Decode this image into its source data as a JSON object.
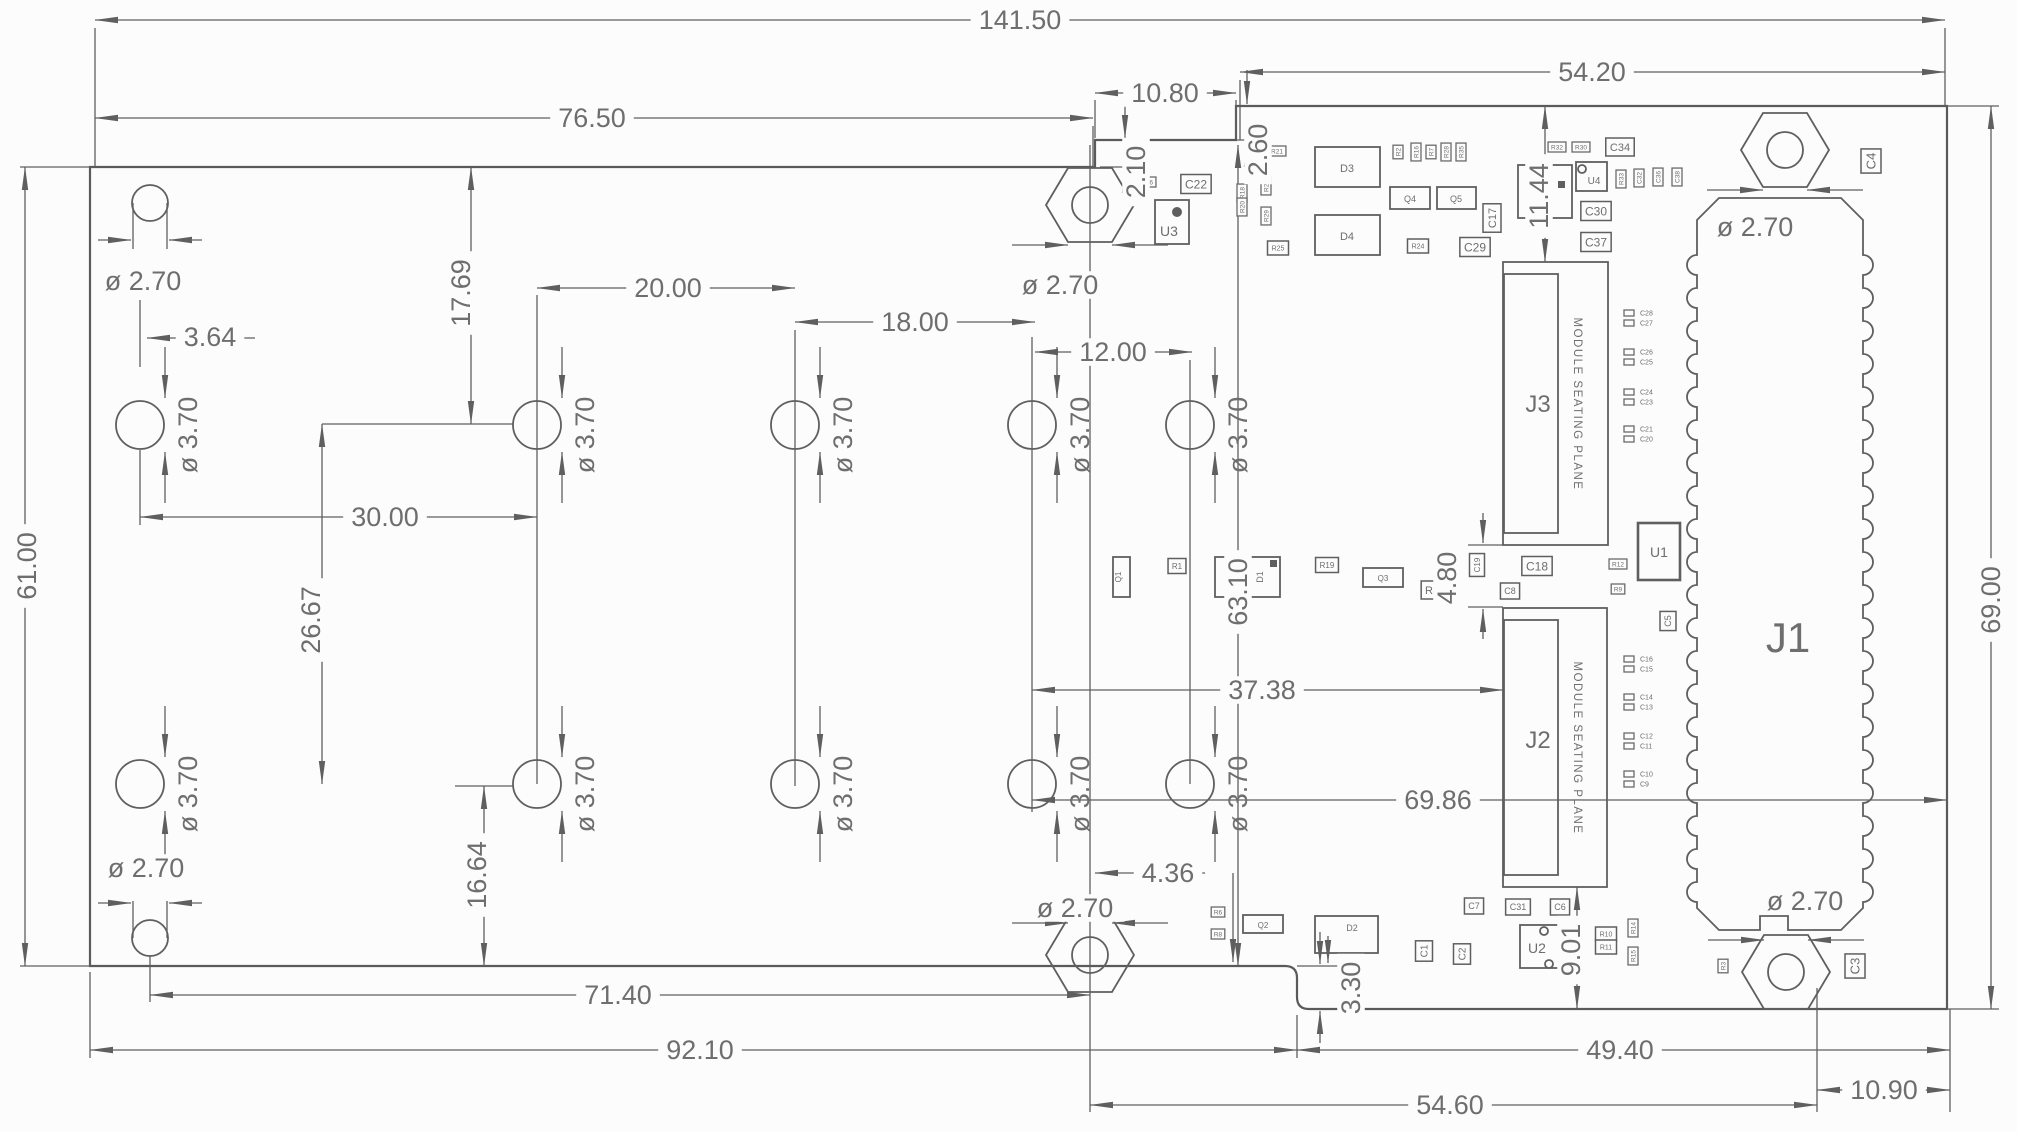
{
  "drawing": {
    "colors": {
      "line": "#5f5f5f",
      "text": "#6e6e6e",
      "background": "#fcfcfc"
    },
    "hole_label": "ø 3.70",
    "dims": [
      {
        "id": "total-width",
        "text": "141.50",
        "x": 1020,
        "y": 20,
        "rot": 0
      },
      {
        "id": "left-top-width",
        "text": "76.50",
        "x": 592,
        "y": 118,
        "rot": 0
      },
      {
        "id": "right-top-width",
        "text": "54.20",
        "x": 1592,
        "y": 72,
        "rot": 0
      },
      {
        "id": "notch-width",
        "text": "10.80",
        "x": 1165,
        "y": 93,
        "rot": 0
      },
      {
        "id": "notch-depth",
        "text": "2.10",
        "x": 1136,
        "y": 172,
        "rot": -90
      },
      {
        "id": "top-step",
        "text": "2.60",
        "x": 1258,
        "y": 150,
        "rot": -90
      },
      {
        "id": "left-height",
        "text": "61.00",
        "x": 27,
        "y": 566,
        "rot": -90
      },
      {
        "id": "right-height",
        "text": "69.00",
        "x": 1991,
        "y": 600,
        "rot": -90
      },
      {
        "id": "hole-a-offset",
        "text": "3.64",
        "x": 210,
        "y": 337,
        "rot": 0
      },
      {
        "id": "top-row-offset",
        "text": "17.69",
        "x": 461,
        "y": 293,
        "rot": -90
      },
      {
        "id": "pitch-30",
        "text": "30.00",
        "x": 385,
        "y": 517,
        "rot": 0
      },
      {
        "id": "pitch-20",
        "text": "20.00",
        "x": 668,
        "y": 288,
        "rot": 0
      },
      {
        "id": "pitch-18",
        "text": "18.00",
        "x": 915,
        "y": 322,
        "rot": 0
      },
      {
        "id": "pitch-12",
        "text": "12.00",
        "x": 1113,
        "y": 352,
        "rot": 0
      },
      {
        "id": "row-spacing",
        "text": "26.67",
        "x": 311,
        "y": 620,
        "rot": -90
      },
      {
        "id": "bottom-row-offset",
        "text": "16.64",
        "x": 477,
        "y": 875,
        "rot": -90
      },
      {
        "id": "mid-height",
        "text": "63.10",
        "x": 1238,
        "y": 592,
        "rot": -90
      },
      {
        "id": "connector-gap",
        "text": "4.80",
        "x": 1447,
        "y": 578,
        "rot": -90
      },
      {
        "id": "l1-offset",
        "text": "11.44",
        "x": 1539,
        "y": 196,
        "rot": -90
      },
      {
        "id": "j2-offset",
        "text": "37.38",
        "x": 1262,
        "y": 690,
        "rot": 0
      },
      {
        "id": "connector-span",
        "text": "69.86",
        "x": 1438,
        "y": 800,
        "rot": 0
      },
      {
        "id": "bottom-71",
        "text": "71.40",
        "x": 618,
        "y": 995,
        "rot": 0
      },
      {
        "id": "bottom-92",
        "text": "92.10",
        "x": 700,
        "y": 1050,
        "rot": 0
      },
      {
        "id": "bottom-49",
        "text": "49.40",
        "x": 1620,
        "y": 1050,
        "rot": 0
      },
      {
        "id": "bottom-54",
        "text": "54.60",
        "x": 1450,
        "y": 1105,
        "rot": 0
      },
      {
        "id": "bottom-10",
        "text": "10.90",
        "x": 1884,
        "y": 1090,
        "rot": 0
      },
      {
        "id": "bottom-step",
        "text": "3.30",
        "x": 1351,
        "y": 988,
        "rot": -90
      },
      {
        "id": "u2-offset",
        "text": "9.01",
        "x": 1571,
        "y": 950,
        "rot": -90
      },
      {
        "id": "hex-offset",
        "text": "4.36",
        "x": 1168,
        "y": 873,
        "rot": 0
      }
    ],
    "dia_labels": [
      {
        "id": "top-left",
        "text": "ø 2.70",
        "x": 143,
        "y": 281
      },
      {
        "id": "top-middle",
        "text": "ø 2.70",
        "x": 1060,
        "y": 285
      },
      {
        "id": "top-right",
        "text": "ø 2.70",
        "x": 1755,
        "y": 227
      },
      {
        "id": "bottom-left",
        "text": "ø 2.70",
        "x": 146,
        "y": 868
      },
      {
        "id": "bottom-middle",
        "text": "ø 2.70",
        "x": 1075,
        "y": 908
      },
      {
        "id": "bottom-right",
        "text": "ø 2.70",
        "x": 1805,
        "y": 901
      }
    ],
    "holes": {
      "rows_y": [
        425,
        784
      ],
      "cols_x": [
        140,
        537,
        795,
        1032,
        1190
      ]
    },
    "corner_holes": [
      {
        "cx": 150,
        "cy": 203,
        "arrows": "below"
      },
      {
        "cx": 150,
        "cy": 938,
        "arrows": "above"
      }
    ],
    "standoffs": [
      {
        "cx": 1090,
        "cy": 205,
        "arrows": "below"
      },
      {
        "cx": 1785,
        "cy": 150,
        "arrows": "below"
      },
      {
        "cx": 1090,
        "cy": 955,
        "arrows": "above"
      },
      {
        "cx": 1786,
        "cy": 972,
        "arrows": "above"
      }
    ],
    "j1": {
      "label": "J1",
      "lx": 1788,
      "ly": 652
    },
    "connectors": [
      {
        "label": "J3",
        "seat_label": "MODULE SEATING PLANE",
        "x": 1503,
        "y": 262,
        "w": 105,
        "h": 283,
        "ix": 1504,
        "iy": 274,
        "iw": 54,
        "ih": 259,
        "lx": 1538,
        "ly": 412,
        "sx": 1578,
        "sy": 404
      },
      {
        "label": "J2",
        "seat_label": "MODULE SEATING PLANE",
        "x": 1503,
        "y": 608,
        "w": 104,
        "h": 279,
        "ix": 1504,
        "iy": 620,
        "iw": 54,
        "ih": 255,
        "lx": 1538,
        "ly": 748,
        "sx": 1578,
        "sy": 748
      }
    ],
    "parts": [
      {
        "label": "U3",
        "x": 1155,
        "y": 200,
        "w": 34,
        "h": 44,
        "fs": 14,
        "lx": 1169,
        "ly": 236,
        "dot": [
          1177,
          212
        ]
      },
      {
        "label": "U4",
        "x": 1576,
        "y": 162,
        "w": 31,
        "h": 29,
        "fs": 10,
        "lx": 1594,
        "ly": 184,
        "ring": [
          1582,
          169
        ]
      },
      {
        "label": "L1",
        "x": 1518,
        "y": 165,
        "w": 54,
        "h": 53,
        "fs": 11,
        "lx": 1536,
        "ly": 197,
        "sq": [
          1558,
          181
        ]
      },
      {
        "label": "D3",
        "x": 1315,
        "y": 147,
        "w": 65,
        "h": 40,
        "fs": 11,
        "lx": 1347,
        "ly": 172
      },
      {
        "label": "D4",
        "x": 1315,
        "y": 215,
        "w": 65,
        "h": 40,
        "fs": 11,
        "lx": 1347,
        "ly": 240
      },
      {
        "label": "Q4",
        "x": 1390,
        "y": 187,
        "w": 40,
        "h": 22,
        "fs": 9,
        "lx": 1410,
        "ly": 202
      },
      {
        "label": "Q5",
        "x": 1437,
        "y": 187,
        "w": 39,
        "h": 22,
        "fs": 9,
        "lx": 1456,
        "ly": 202
      },
      {
        "label": "Q1",
        "x": 1113,
        "y": 557,
        "w": 17,
        "h": 40,
        "fs": 8,
        "lx": 1121,
        "ly": 577,
        "rot": -90
      },
      {
        "label": "Q3",
        "x": 1363,
        "y": 568,
        "w": 40,
        "h": 19,
        "fs": 8,
        "lx": 1383,
        "ly": 581
      },
      {
        "label": "D1",
        "x": 1215,
        "y": 557,
        "w": 65,
        "h": 40,
        "fs": 9,
        "lx": 1263,
        "ly": 577,
        "rot": -90,
        "sq": [
          1270,
          560
        ]
      },
      {
        "label": "U1",
        "x": 1638,
        "y": 523,
        "w": 42,
        "h": 57,
        "fs": 14,
        "lx": 1659,
        "ly": 557,
        "thick": true
      },
      {
        "label": "U2",
        "x": 1520,
        "y": 925,
        "w": 48,
        "h": 43,
        "fs": 14,
        "lx": 1537,
        "ly": 953,
        "ring": [
          1544,
          931
        ],
        "ring2": [
          1549,
          964
        ]
      },
      {
        "label": "Q2",
        "x": 1243,
        "y": 915,
        "w": 40,
        "h": 18,
        "fs": 8,
        "lx": 1263,
        "ly": 928
      },
      {
        "label": "D2",
        "x": 1315,
        "y": 916,
        "w": 63,
        "h": 37,
        "fs": 9,
        "lx": 1352,
        "ly": 931
      }
    ],
    "boxed": [
      {
        "text": "C22",
        "x": 1196,
        "y": 184,
        "fs": 12
      },
      {
        "text": "C29",
        "x": 1475,
        "y": 247,
        "fs": 12
      },
      {
        "text": "C30",
        "x": 1596,
        "y": 211,
        "fs": 12
      },
      {
        "text": "C37",
        "x": 1596,
        "y": 242,
        "fs": 12
      },
      {
        "text": "C34",
        "x": 1620,
        "y": 147,
        "fs": 11
      },
      {
        "text": "C17",
        "x": 1492,
        "y": 218,
        "fs": 11,
        "vert": true
      },
      {
        "text": "C4",
        "x": 1871,
        "y": 161,
        "fs": 13,
        "vert": true
      },
      {
        "text": "C18",
        "x": 1537,
        "y": 566,
        "fs": 12
      },
      {
        "text": "C8",
        "x": 1510,
        "y": 591,
        "fs": 9
      },
      {
        "text": "C19",
        "x": 1477,
        "y": 565,
        "fs": 8,
        "vert": true
      },
      {
        "text": "R19",
        "x": 1327,
        "y": 565,
        "fs": 8
      },
      {
        "text": "R4",
        "x": 1432,
        "y": 590,
        "fs": 11
      },
      {
        "text": "R1",
        "x": 1177,
        "y": 566,
        "fs": 8
      },
      {
        "text": "C7",
        "x": 1474,
        "y": 906,
        "fs": 9
      },
      {
        "text": "C31",
        "x": 1518,
        "y": 907,
        "fs": 9
      },
      {
        "text": "C6",
        "x": 1560,
        "y": 907,
        "fs": 9
      },
      {
        "text": "C1",
        "x": 1424,
        "y": 951,
        "fs": 10,
        "vert": true
      },
      {
        "text": "C2",
        "x": 1462,
        "y": 954,
        "fs": 10,
        "vert": true
      },
      {
        "text": "C3",
        "x": 1855,
        "y": 966,
        "fs": 13,
        "vert": true
      },
      {
        "text": "C5",
        "x": 1668,
        "y": 621,
        "fs": 9,
        "vert": true
      },
      {
        "text": "R10",
        "x": 1606,
        "y": 934,
        "fs": 7
      },
      {
        "text": "R11",
        "x": 1606,
        "y": 947,
        "fs": 7
      },
      {
        "text": "R25",
        "x": 1278,
        "y": 248,
        "fs": 7
      },
      {
        "text": "R24",
        "x": 1418,
        "y": 246,
        "fs": 7
      }
    ],
    "tiny_parts": [
      {
        "text": "R36",
        "x": 1147,
        "y": 182
      },
      {
        "text": "R21",
        "x": 1277,
        "y": 151
      },
      {
        "text": "R18",
        "x": 1242,
        "y": 193,
        "vert": true
      },
      {
        "text": "R20",
        "x": 1242,
        "y": 207,
        "vert": true
      },
      {
        "text": "R26",
        "x": 1266,
        "y": 186,
        "vert": true
      },
      {
        "text": "R29",
        "x": 1266,
        "y": 216,
        "vert": true
      },
      {
        "text": "R2",
        "x": 1398,
        "y": 152,
        "vert": true
      },
      {
        "text": "R16",
        "x": 1416,
        "y": 152,
        "vert": true
      },
      {
        "text": "R7",
        "x": 1431,
        "y": 152,
        "vert": true
      },
      {
        "text": "R28",
        "x": 1446,
        "y": 152,
        "vert": true
      },
      {
        "text": "R35",
        "x": 1461,
        "y": 152,
        "vert": true
      },
      {
        "text": "R32",
        "x": 1557,
        "y": 147
      },
      {
        "text": "R30",
        "x": 1581,
        "y": 147
      },
      {
        "text": "R33",
        "x": 1621,
        "y": 179,
        "vert": true
      },
      {
        "text": "C32",
        "x": 1639,
        "y": 178,
        "vert": true
      },
      {
        "text": "C36",
        "x": 1658,
        "y": 177,
        "vert": true
      },
      {
        "text": "C38",
        "x": 1677,
        "y": 177,
        "vert": true
      },
      {
        "text": "R12",
        "x": 1618,
        "y": 564
      },
      {
        "text": "R9",
        "x": 1618,
        "y": 589
      },
      {
        "text": "R6",
        "x": 1218,
        "y": 912
      },
      {
        "text": "R8",
        "x": 1218,
        "y": 934
      },
      {
        "text": "R13",
        "x": 1352,
        "y": 970
      },
      {
        "text": "R14",
        "x": 1633,
        "y": 928,
        "vert": true
      },
      {
        "text": "R15",
        "x": 1633,
        "y": 956,
        "vert": true
      },
      {
        "text": "R3",
        "x": 1723,
        "y": 966,
        "vert": true
      }
    ],
    "cap_pairs": [
      {
        "top": "C28",
        "bottom": "C27",
        "y": 313
      },
      {
        "top": "C26",
        "bottom": "C25",
        "y": 352
      },
      {
        "top": "C24",
        "bottom": "C23",
        "y": 392
      },
      {
        "top": "C21",
        "bottom": "C20",
        "y": 429
      },
      {
        "top": "C16",
        "bottom": "C15",
        "y": 659
      },
      {
        "top": "C14",
        "bottom": "C13",
        "y": 697
      },
      {
        "top": "C12",
        "bottom": "C11",
        "y": 736
      },
      {
        "top": "C10",
        "bottom": "C9",
        "y": 774
      }
    ]
  }
}
